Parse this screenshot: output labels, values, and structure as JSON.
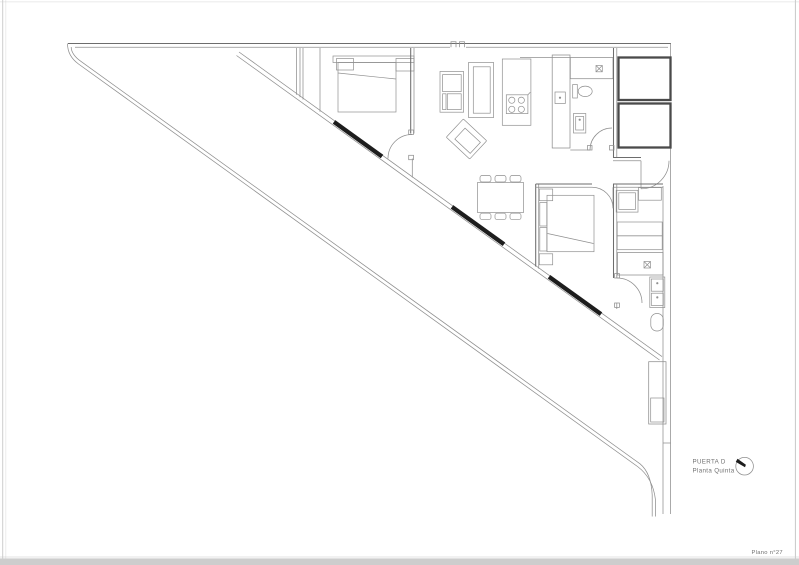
{
  "sheet": {
    "drawing_number": "Plano n°27"
  },
  "title_block": {
    "door_label": "PUERTA D",
    "floor_label": "Planta Quinta"
  },
  "icons": {
    "north_arrow": "circle-with-black-needle-pointing-northwest",
    "shower_drain": "x-in-square",
    "hob": "four-burner-circles"
  },
  "colors": {
    "paper": "#ffffff",
    "line": "#8f8f8f",
    "wall": "#6d6d6d",
    "core": "#4a4a4a",
    "mullion": "#1d1d1d",
    "label_text": "#717171",
    "page_edge": "#cdcdcd"
  }
}
